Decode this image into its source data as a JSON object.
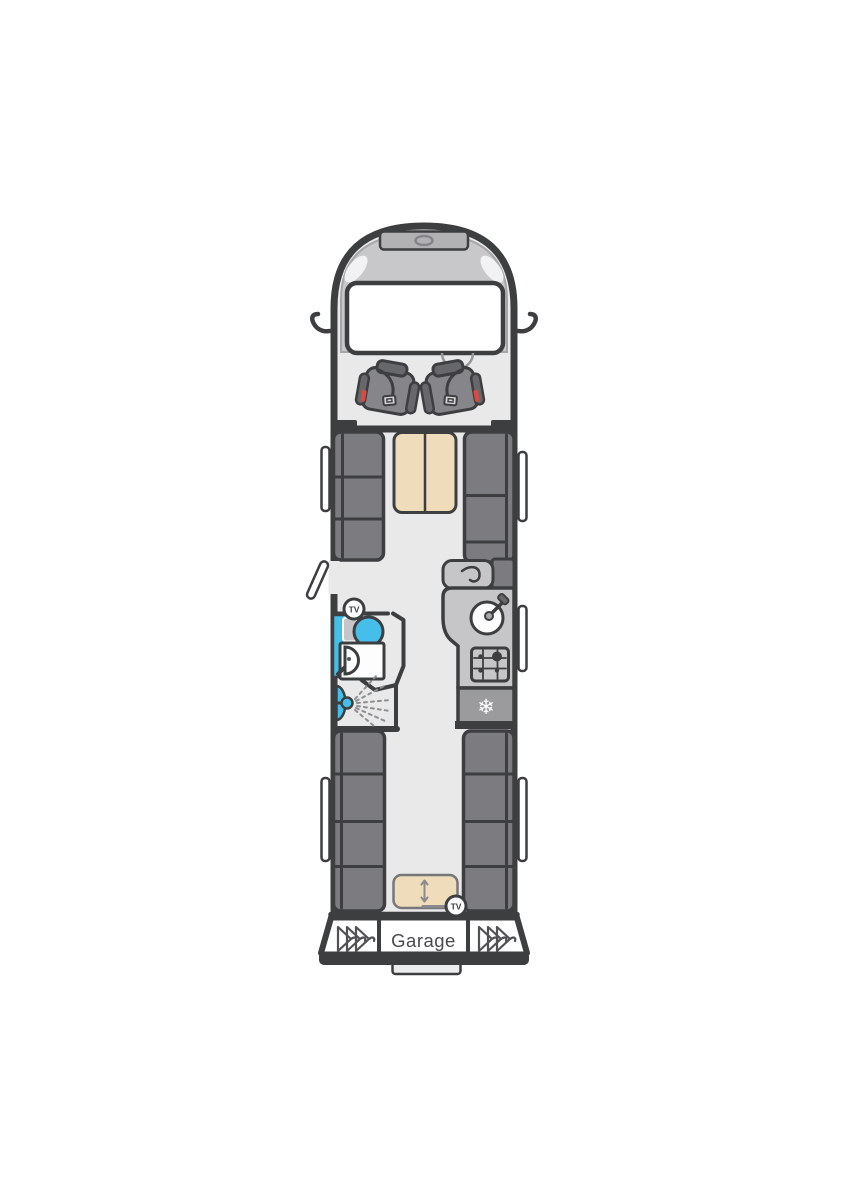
{
  "floorplan": {
    "title": "Motorhome overhead floorplan",
    "labels": {
      "garage": "Garage",
      "tv_front": "TV",
      "tv_rear": "TV",
      "fridge_symbol": "❄"
    },
    "colors": {
      "outline": "#3d3e40",
      "body": "#e9e9ea",
      "cab_band": "#c8c8ca",
      "roof_vent": "#b2b2b4",
      "windscreen": "#ffffff",
      "sofa": "#7c7c80",
      "sofa_dark": "#68686c",
      "seat_base": "#85858a",
      "table_wood": "#eedcba",
      "water_blue": "#45bfe9",
      "kitchen_unit": "#c6c6c8",
      "fridge_gray": "#9b9b9e",
      "seatbelt_red": "#d94a43",
      "window_white": "#ffffff",
      "detail_gray": "#8a8a8e",
      "label_text": "#4a4a4d"
    }
  }
}
